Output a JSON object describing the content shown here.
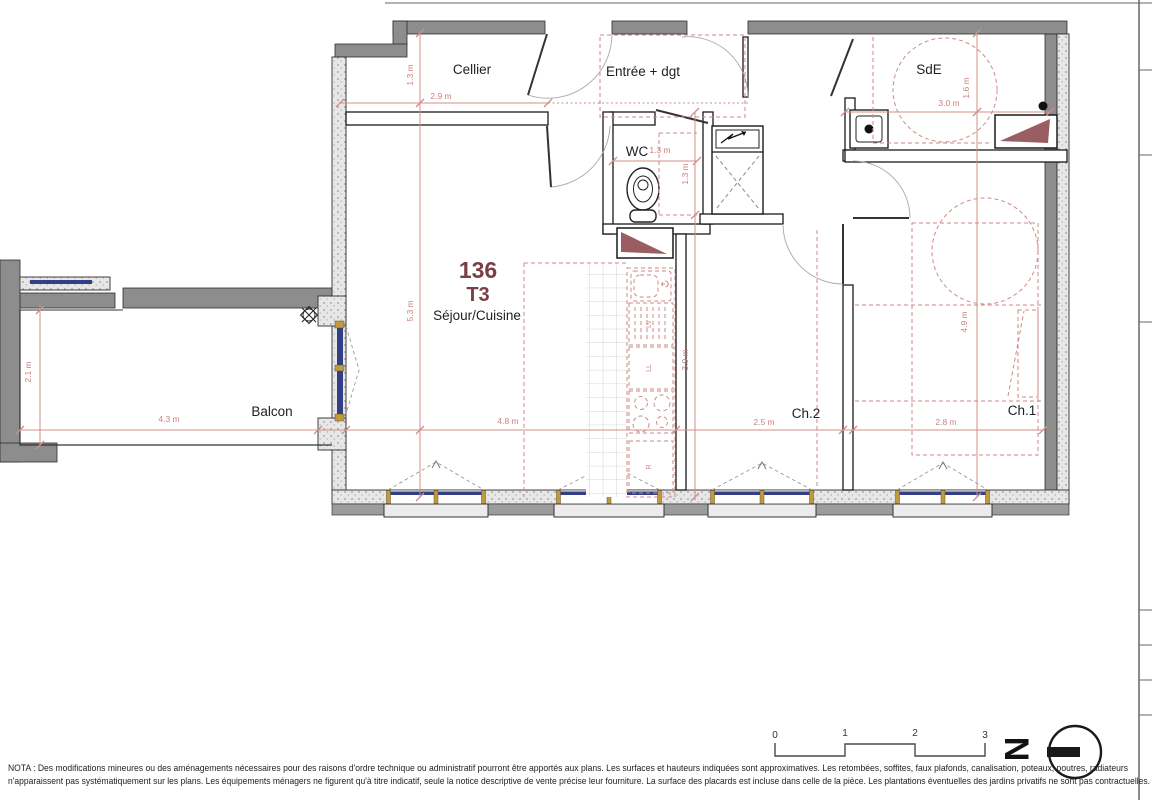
{
  "plan": {
    "unit_number": "136",
    "unit_type": "T3",
    "rooms": {
      "cellier": "Cellier",
      "entree": "Entrée + dgt",
      "sde": "SdE",
      "wc": "WC",
      "sejour_cuisine": "Séjour/Cuisine",
      "ch2": "Ch.2",
      "ch1": "Ch.1",
      "balcon": "Balcon"
    },
    "dims": {
      "cellier_w": "2.9 m",
      "cellier_d": "1.3 m",
      "sejour_d": "5.3 m",
      "sejour_w": "4.8 m",
      "kitchen_d": "3.9 m",
      "wc_w": "1.3 m",
      "wc_d": "1.3 m",
      "sde_w": "3.0 m",
      "sde_d": "1.6 m",
      "ch2_w": "2.5 m",
      "ch1_w": "2.8 m",
      "ch1_d": "4.9 m",
      "balcon_w": "4.3 m",
      "balcon_d": "2.1 m"
    },
    "appliances": {
      "dishwasher": "LV",
      "washing_machine": "LL",
      "fridge": "R"
    }
  },
  "scale_bar": {
    "ticks": [
      "0",
      "1",
      "2",
      "3"
    ]
  },
  "north": {
    "letter": "N"
  },
  "nota": {
    "line1": "NOTA : Des modifications mineures ou des aménagements nécessaires pour des raisons d'ordre technique ou administratif pourront être apportés aux plans. Les surfaces et hauteurs indiquées sont approximatives. Les retombées, soffites, faux plafonds, canalisation, poteaux, poutres, radiateurs",
    "line2": "n'apparaissent pas systématiquement sur les plans.  Les équipements ménagers ne figurent qu'à titre indicatif, seule la notice descriptive de vente précise leur fourniture. La surface des placards est incluse dans celle de la pièce. Les plantations éventuelles des jardins privatifs ne sont pas contractuelles."
  },
  "colors": {
    "dim_red": "#d08f8b",
    "construction_red": "#cd8a88",
    "unit_maroon": "#7a3e46",
    "wall_gray": "#8d8d8d",
    "glazing_blue": "#323f87",
    "frame_yellow": "#c09a3e",
    "duct_maroon": "#9a5e62"
  }
}
